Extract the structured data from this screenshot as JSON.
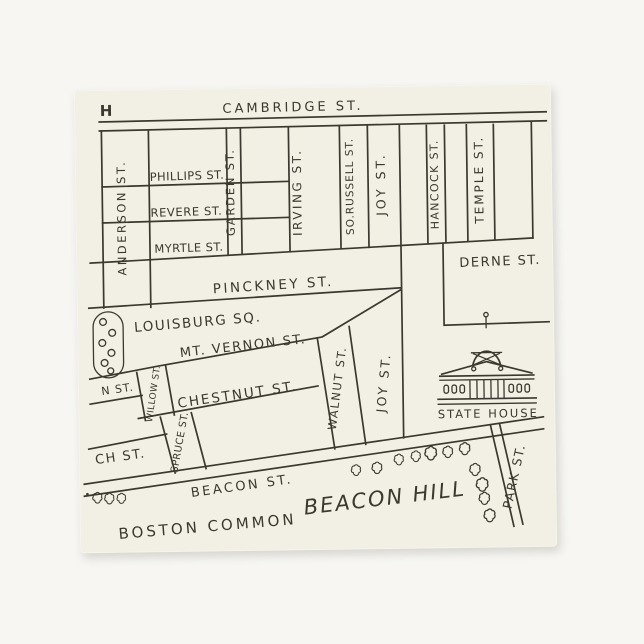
{
  "colors": {
    "page_bg": "#f7f6f3",
    "napkin": "#f2efe4",
    "ink": "#3b382f"
  },
  "map": {
    "corner_letter": "H",
    "streets": {
      "cambridge": "CAMBRIDGE ST.",
      "anderson": "ANDERSON ST.",
      "phillips": "PHILLIPS ST.",
      "revere": "REVERE ST.",
      "myrtle": "MYRTLE ST.",
      "garden": "GARDEN ST.",
      "irving": "IRVING ST.",
      "so_russell": "SO.RUSSELL ST.",
      "joy_upper": "JOY ST.",
      "hancock": "HANCOCK ST.",
      "temple": "TEMPLE ST.",
      "derne": "DERNE ST.",
      "pinckney": "PINCKNEY ST.",
      "louisburg_sq": "LOUISBURG SQ.",
      "mt_vernon": "MT. VERNON ST.",
      "n_st_partial": "N ST.",
      "willow": "WILLOW ST.",
      "chestnut": "CHESTNUT ST.",
      "walnut": "WALNUT ST.",
      "joy_lower": "JOY ST.",
      "spruce": "SPRUCE ST.",
      "ch_st_partial": "CH ST.",
      "beacon": "BEACON ST.",
      "park": "PARK ST."
    },
    "landmarks": {
      "state_house": "STATE HOUSE",
      "beacon_hill": "BEACON HILL",
      "boston_common": "BOSTON COMMON"
    }
  }
}
